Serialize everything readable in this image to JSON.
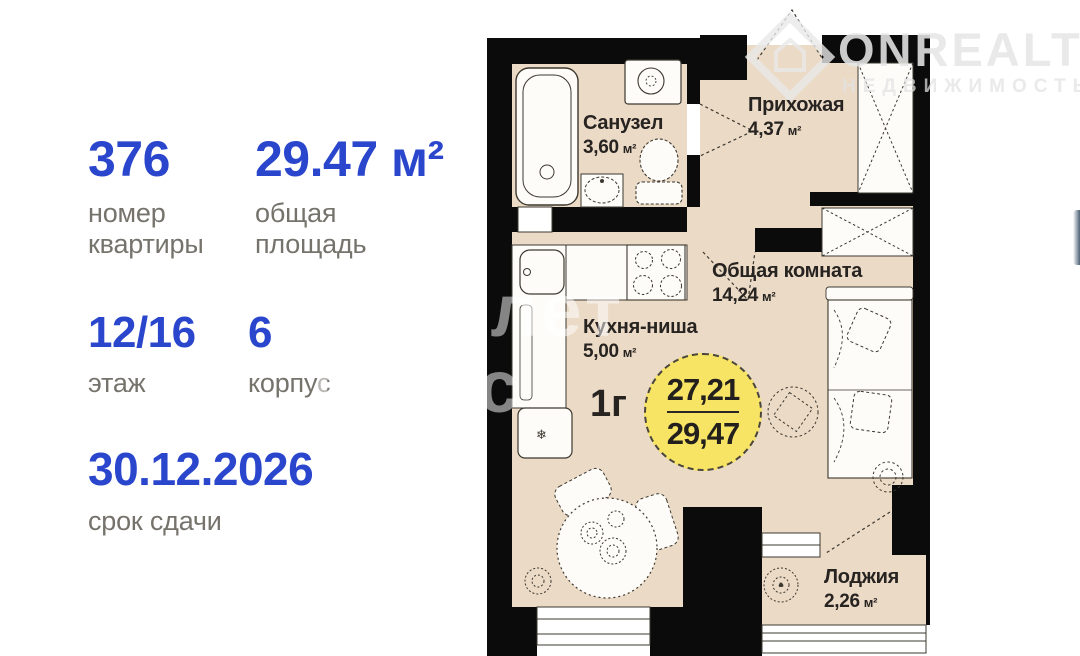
{
  "info_panel": {
    "apartment": {
      "value": "376",
      "label1": "номер",
      "label2": "квартиры"
    },
    "area": {
      "value": "29.47 м²",
      "label1": "общая",
      "label2": "площадь"
    },
    "floor": {
      "value": "12/16",
      "label1": "этаж"
    },
    "building": {
      "value": "6",
      "label1": "корпус"
    },
    "deadline": {
      "value": "30.12.2026",
      "label1": "срок сдачи"
    }
  },
  "plan": {
    "unit_type": "1г",
    "badge": {
      "living_area": "27,21",
      "total_area": "29,47"
    },
    "rooms": {
      "bathroom": {
        "name": "Санузел",
        "area": "3,60",
        "unit": "м²"
      },
      "hallway": {
        "name": "Прихожая",
        "area": "4,37",
        "unit": "м²"
      },
      "living": {
        "name": "Общая комната",
        "area": "14,24",
        "unit": "м²"
      },
      "kitchen": {
        "name": "Кухня-ниша",
        "area": "5,00",
        "unit": "м²"
      },
      "loggia": {
        "name": "Лоджия",
        "area": "2,26",
        "unit": "м²"
      }
    }
  },
  "watermarks": {
    "brand": "ONREALT",
    "brand_sub": "НЕДВИЖИМОСТЬ",
    "agency_line1": "Самолет",
    "agency_line2": "плюс"
  },
  "colors": {
    "accent_blue": "#2a46cd",
    "label_gray": "#76736c",
    "floor_beige": "#ebdac6",
    "wall_black": "#0b0b0b",
    "badge_yellow": "#f7e364"
  }
}
